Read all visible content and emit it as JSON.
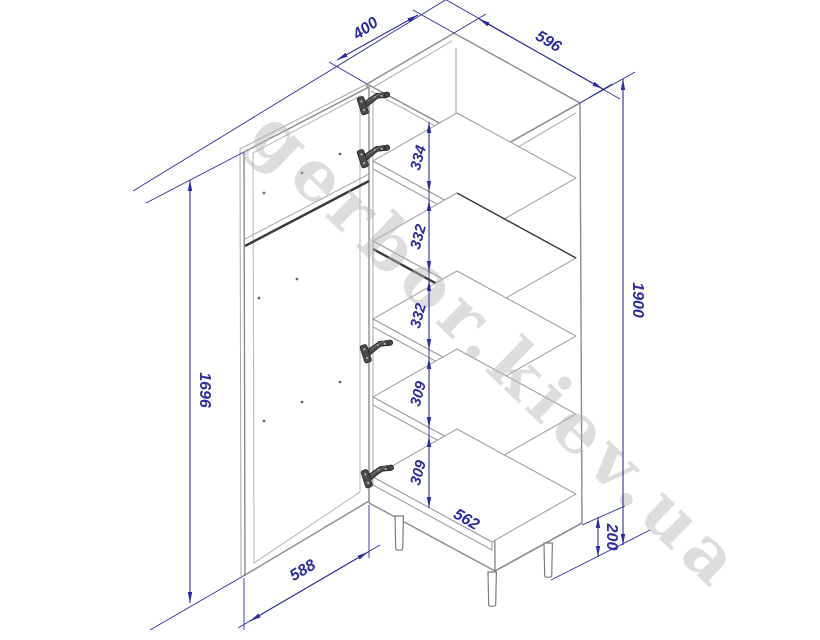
{
  "meta": {
    "type": "furniture technical drawing",
    "units": "mm"
  },
  "watermark": {
    "text": "gerbor.kiev.ua"
  },
  "cabinet": {
    "dims": {
      "depth": "400",
      "width": "596",
      "height": "1900",
      "door_height": "1696",
      "door_width": "588",
      "leg_height": "200",
      "inner_bottom_width": "562",
      "gaps": {
        "g1": "334",
        "g2": "332",
        "g3": "332",
        "g4": "309",
        "g5": "309"
      }
    }
  },
  "colors": {
    "dimension": "#2d2d9d",
    "outline": "#8a8a8a",
    "dark_edge": "#3a3a3a",
    "watermark": "#b5b5b5",
    "background": "#ffffff"
  }
}
